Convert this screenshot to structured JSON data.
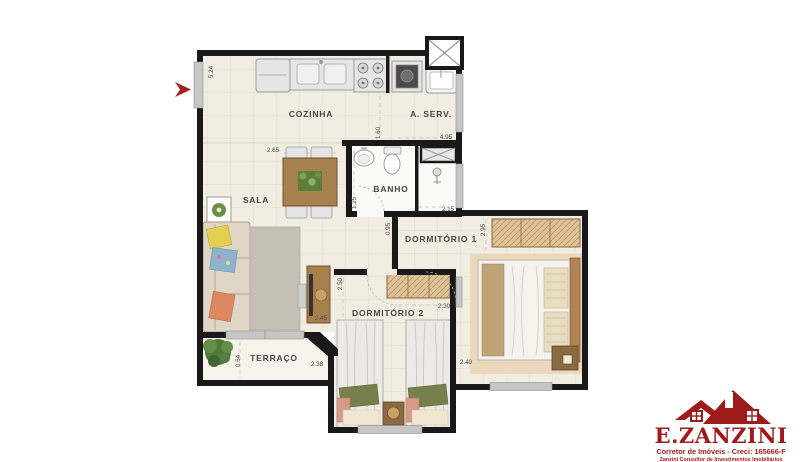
{
  "plan": {
    "rooms": {
      "cozinha": {
        "label": "COZINHA"
      },
      "area_servico": {
        "label": "A. SERV."
      },
      "sala": {
        "label": "SALA"
      },
      "banho": {
        "label": "BANHO"
      },
      "dormitorio1": {
        "label": "DORMITÓRIO 1"
      },
      "dormitorio2": {
        "label": "DORMITÓRIO 2"
      },
      "terraco": {
        "label": "TERRAÇO"
      }
    },
    "dimensions": {
      "entry_wall": "5.24",
      "sala_width": "2.65",
      "cozinha_depth": "1.60",
      "aserv_width": "4.95",
      "banho_depth": "1.25",
      "banho_width": "2.15",
      "hall_depth": "0.95",
      "dorm1_depth": "2.95",
      "dorm2_depth": "2.50",
      "dorm2_width": "2.30",
      "rack_width": "2.45",
      "dorm1_width": "2.40",
      "terraco_width": "2.38",
      "terraco_depth": "0.64"
    }
  },
  "logo": {
    "brand": "E.ZANZINI",
    "tagline": "Corretor de Imóveis - Creci: 165666-F",
    "subtitle": "Zanzini Consultor de Investimentos Imobiliários"
  },
  "colors": {
    "wall": "#191919",
    "floor": "#f1ede2",
    "terrace_floor": "#f6f3ea",
    "bath_floor": "#fafaf7",
    "window_gray": "#c6c6c6",
    "wood": "#a8804e",
    "wardrobe_tan": "#e0c498",
    "logo_red": "#9e1b1b",
    "arrow_red": "#a62222"
  }
}
